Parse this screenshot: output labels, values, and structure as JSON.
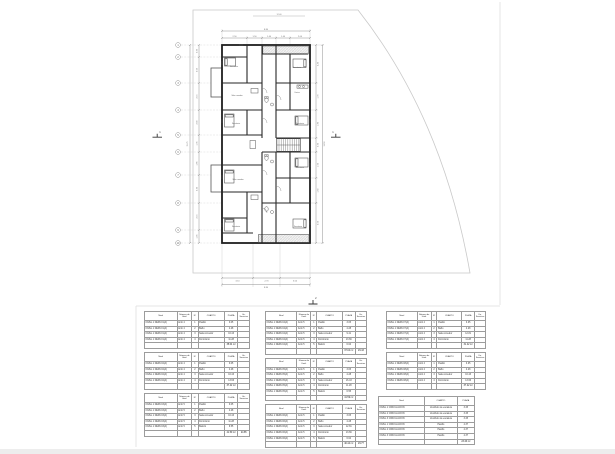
{
  "plan": {
    "site_width_label": "12.40",
    "grid_bubbles": [
      "1",
      "2",
      "3",
      "4",
      "5",
      "6",
      "7",
      "8",
      "9",
      "10"
    ],
    "sections": [
      "1",
      "1",
      "2"
    ],
    "dims": {
      "top": [
        "2.50",
        "1.50",
        "1.40",
        "1.40",
        "2.00"
      ],
      "top_overall": "8.80",
      "bottom": [
        "3.10",
        "2.70",
        "3.00"
      ],
      "bottom_overall": "8.80",
      "left": [
        "0.95",
        "2.05",
        "2.15",
        "2.00",
        "1.35",
        "1.85",
        "2.20",
        "2.15",
        "1.05"
      ],
      "left_overall": "15.75",
      "right": [
        "2.40",
        "1.70",
        "1.80",
        "0.90",
        "1.60",
        "1.60",
        "2.50"
      ],
      "right_overall": "12.50"
    },
    "rooms": [
      "Dormitorio",
      "Dormitorio",
      "Sala comedor",
      "Cocina",
      "Dormitorio",
      "Dormitorio",
      "Sala comedor",
      "Dormitorio",
      "Dormitorio",
      "Dormitorio"
    ]
  },
  "tables": {
    "groups": [
      {
        "tables": [
          {
            "header": [
              "Nivel",
              "Número de Unid.",
              "N°",
              "CUARTO",
              "PLAZA",
              "Un. Servicios"
            ],
            "rows": [
              [
                "NIVEL 1 DEPA 01(A)",
                "Amb 4",
                "1",
                "Pasillo",
                "3.05",
                ""
              ],
              [
                "NIVEL 1 DEPA 01(A)",
                "Amb 4",
                "2",
                "Baño",
                "4.28",
                ""
              ],
              [
                "NIVEL 1 DEPA 01(A)",
                "Amb 4",
                "3",
                "Sala comedor",
                "16.43",
                ""
              ],
              [
                "NIVEL 1 DEPA 01(A)",
                "Amb 4",
                "4",
                "Dormitorio",
                "11.28",
                ""
              ],
              [
                "",
                "",
                "",
                "",
                "35.04 m²",
                ""
              ]
            ]
          },
          {
            "header": [
              "Nivel",
              "Número de Unid.",
              "N°",
              "CUARTO",
              "PLAZA",
              "Un. Servicios"
            ],
            "rows": [
              [
                "NIVEL 1 DEPA 02(A)",
                "Amb 4",
                "1",
                "Pasillo",
                "3.05",
                ""
              ],
              [
                "NIVEL 1 DEPA 02(A)",
                "Amb 4",
                "2",
                "Baño",
                "4.28",
                ""
              ],
              [
                "NIVEL 1 DEPA 02(A)",
                "Amb 4",
                "3",
                "Sala comedor",
                "16.43",
                ""
              ],
              [
                "NIVEL 1 DEPA 02(A)",
                "Amb 4",
                "4",
                "Dormitorio",
                "13.66",
                ""
              ],
              [
                "",
                "",
                "",
                "",
                "37.42 m²",
                ""
              ]
            ]
          },
          {
            "header": [
              "Nivel",
              "Número de Unid.",
              "N°",
              "CUARTO",
              "PLAZA",
              "Un. Servicios"
            ],
            "rows": [
              [
                "NIVEL 1 DEPA 03(A)",
                "Amb 5",
                "1",
                "Pasillo",
                "3.05",
                ""
              ],
              [
                "NIVEL 1 DEPA 03(A)",
                "Amb 5",
                "2",
                "Baño",
                "4.28",
                ""
              ],
              [
                "NIVEL 1 DEPA 03(A)",
                "Amb 5",
                "3",
                "Sala comedor",
                "16.43",
                ""
              ],
              [
                "NIVEL 1 DEPA 03(A)",
                "Amb 5",
                "4",
                "Dormitorio",
                "11.28",
                ""
              ],
              [
                "NIVEL 1 DEPA 03(A)",
                "Amb 5",
                "5",
                "Balcón",
                "6.55",
                ""
              ],
              [
                "",
                "",
                "",
                "",
                "41.59 m²",
                "24.85"
              ]
            ]
          }
        ]
      },
      {
        "tables": [
          {
            "header": [
              "Nivel",
              "Número de Unid.",
              "N°",
              "CUARTO",
              "PLAZA",
              "Un. Servicios"
            ],
            "rows": [
              [
                "NIVEL 1 DEPA 04(A)",
                "Amb 5",
                "1",
                "Pasillo",
                "3.05",
                ""
              ],
              [
                "NIVEL 1 DEPA 04(A)",
                "Amb 5",
                "2",
                "Baño",
                "4.28",
                ""
              ],
              [
                "NIVEL 1 DEPA 04(A)",
                "Amb 5",
                "3",
                "Sala comedor",
                "9.41",
                ""
              ],
              [
                "NIVEL 1 DEPA 04(A)",
                "Amb 5",
                "4",
                "Dormitorio",
                "13.66",
                ""
              ],
              [
                "NIVEL 1 DEPA 04(A)",
                "Amb 5",
                "5",
                "Balcón",
                "6.64",
                ""
              ],
              [
                "",
                "",
                "",
                "",
                "37.04 m²",
                "29.43"
              ]
            ]
          },
          {
            "header": [
              "Nivel",
              "Número de Unid.",
              "N°",
              "CUARTO",
              "PLAZA",
              "Un. Servicios"
            ],
            "rows": [
              [
                "NIVEL 1 DEPA 05(A)",
                "Amb 5",
                "1",
                "Pasillo",
                "3.05",
                ""
              ],
              [
                "NIVEL 1 DEPA 05(A)",
                "Amb 5",
                "2",
                "Baño",
                "4.28",
                ""
              ],
              [
                "NIVEL 1 DEPA 05(A)",
                "Amb 5",
                "3",
                "Sala comedor",
                "16.43",
                ""
              ],
              [
                "NIVEL 1 DEPA 05(A)",
                "Amb 5",
                "4",
                "Dormitorio",
                "11.28",
                ""
              ],
              [
                "NIVEL 1 DEPA 05(A)",
                "Amb 5",
                "5",
                "Balcón",
                "6.55",
                ""
              ],
              [
                "",
                "",
                "",
                "",
                "41.59 m²",
                ""
              ]
            ]
          },
          {
            "header": [
              "Nivel",
              "Número de Unid.",
              "N°",
              "CUARTO",
              "PLAZA",
              "Un. Servicios"
            ],
            "rows": [
              [
                "NIVEL 1 DEPA 06(A)",
                "Amb 5",
                "1",
                "Pasillo",
                "3.05",
                ""
              ],
              [
                "NIVEL 1 DEPA 06(A)",
                "Amb 5",
                "2",
                "Baño",
                "4.28",
                ""
              ],
              [
                "NIVEL 1 DEPA 06(A)",
                "Amb 5",
                "3",
                "Sala comedor",
                "12.81",
                ""
              ],
              [
                "NIVEL 1 DEPA 06(A)",
                "Amb 5",
                "4",
                "Dormitorio",
                "13.66",
                ""
              ],
              [
                "NIVEL 1 DEPA 06(A)",
                "Amb 5",
                "5",
                "Balcón",
                "6.64",
                ""
              ],
              [
                "",
                "",
                "",
                "",
                "40.44 m²",
                "29.77"
              ]
            ]
          }
        ]
      },
      {
        "tables": [
          {
            "header": [
              "Nivel",
              "Número de Unid.",
              "N°",
              "CUARTO",
              "PLAZA",
              "Un. Servicios"
            ],
            "rows": [
              [
                "NIVEL 1 DEPA 07(A)",
                "Amb 4",
                "1",
                "Pasillo",
                "3.05",
                ""
              ],
              [
                "NIVEL 1 DEPA 07(A)",
                "Amb 4",
                "2",
                "Baño",
                "4.28",
                ""
              ],
              [
                "NIVEL 1 DEPA 07(A)",
                "Amb 4",
                "3",
                "Sala comedor",
                "12.81",
                ""
              ],
              [
                "NIVEL 1 DEPA 07(A)",
                "Amb 4",
                "4",
                "Dormitorio",
                "11.28",
                ""
              ],
              [
                "",
                "",
                "",
                "",
                "31.42 m²",
                ""
              ]
            ]
          },
          {
            "header": [
              "Nivel",
              "Número de Unid.",
              "N°",
              "CUARTO",
              "PLAZA",
              "Un. Servicios"
            ],
            "rows": [
              [
                "NIVEL 1 DEPA 08(A)",
                "Amb 4",
                "1",
                "Pasillo",
                "3.05",
                ""
              ],
              [
                "NIVEL 1 DEPA 08(A)",
                "Amb 4",
                "2",
                "Baño",
                "4.28",
                ""
              ],
              [
                "NIVEL 1 DEPA 08(A)",
                "Amb 4",
                "3",
                "Sala comedor",
                "16.43",
                ""
              ],
              [
                "NIVEL 1 DEPA 08(A)",
                "Amb 4",
                "4",
                "Dormitorio",
                "13.66",
                ""
              ],
              [
                "",
                "",
                "",
                "",
                "37.42 m²",
                ""
              ]
            ]
          }
        ]
      },
      {
        "tables": [
          {
            "header": [
              "Nivel",
              "CUARTO",
              "PLAZA"
            ],
            "rows": [
              [
                "NIVEL 1 CIRCULACIÓN",
                "Vestíbulo de escalera",
                "3.45"
              ],
              [
                "NIVEL 2 CIRCULACIÓN",
                "Vestíbulo de escalera",
                "3.45"
              ],
              [
                "NIVEL 3 CIRCULACIÓN",
                "Vestíbulo de escalera",
                "3.45"
              ],
              [
                "NIVEL 1 CIRCULACIÓN",
                "Pasillo",
                "4.37"
              ],
              [
                "NIVEL 2 CIRCULACIÓN",
                "Pasillo",
                "4.37"
              ],
              [
                "NIVEL 3 CIRCULACIÓN",
                "Pasillo",
                "4.37"
              ],
              [
                "",
                "",
                "23.46 m²"
              ]
            ]
          }
        ]
      }
    ]
  }
}
